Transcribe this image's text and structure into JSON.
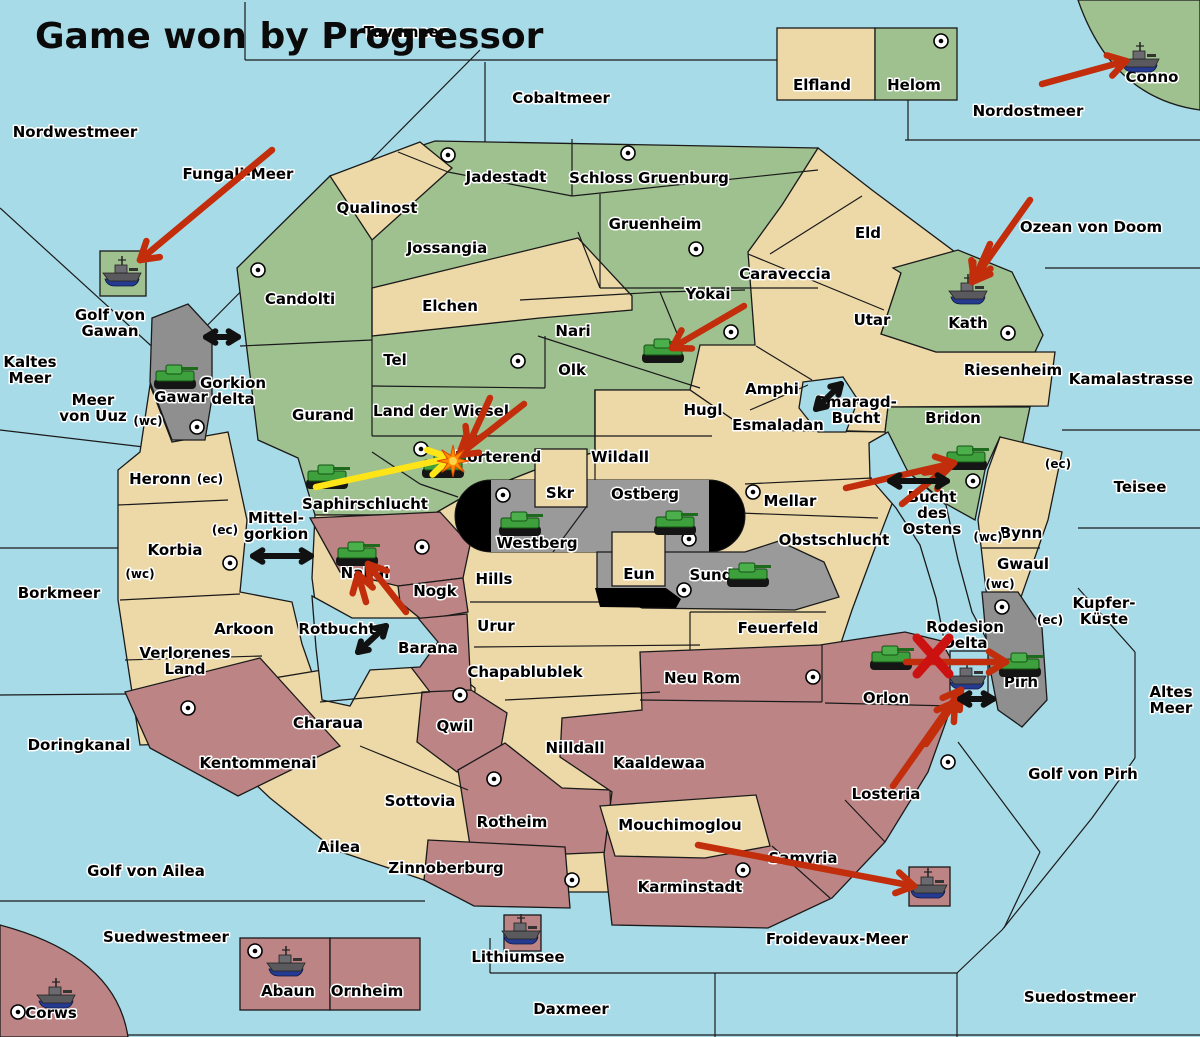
{
  "title": {
    "text": "Game won by Progressor"
  },
  "palette": {
    "sea": "#A8DBE8",
    "green": "#9FC08F",
    "tan": "#EDD9A8",
    "maroon": "#BC8484",
    "gray": "#8F8F8F",
    "stadium_gray": "#9A9A9A",
    "black": "#000000",
    "arrow_red": "#C22D0C",
    "arrow_yellow": "#FFE418",
    "arrow_black": "#111111",
    "x_red": "#CC1111",
    "explosion_orange": "#FF8A00",
    "tank_green": "#3DA03D",
    "ship_hull": "#5A5A5E",
    "ship_keel": "#243B91",
    "border": "#1A1A1A",
    "label_halo": "#FFFFFF"
  },
  "labels": [
    {
      "id": "nordwestmeer",
      "kind": "sea",
      "text": "Nordwestmeer",
      "x": 75,
      "y": 137
    },
    {
      "id": "tuvameer",
      "kind": "sea",
      "text": "Tuvameer",
      "x": 405,
      "y": 37
    },
    {
      "id": "cobaltmeer",
      "kind": "sea",
      "text": "Cobaltmeer",
      "x": 561,
      "y": 103
    },
    {
      "id": "nordostmeer",
      "kind": "sea",
      "text": "Nordostmeer",
      "x": 1028,
      "y": 116
    },
    {
      "id": "fungali-meer",
      "kind": "sea",
      "text": "Fungali-Meer",
      "x": 238,
      "y": 179
    },
    {
      "id": "kaltes-meer",
      "kind": "sea",
      "text": "Kaltes\nMeer",
      "x": 30,
      "y": 375
    },
    {
      "id": "golf-von-gawan",
      "kind": "sea",
      "text": "Golf von\nGawan",
      "x": 110,
      "y": 328
    },
    {
      "id": "meer-von-uuz",
      "kind": "sea",
      "text": "Meer\nvon Uuz",
      "x": 93,
      "y": 413
    },
    {
      "id": "gorkion-delta",
      "kind": "sea",
      "text": "Gorkion\ndelta",
      "x": 233,
      "y": 396
    },
    {
      "id": "borkmeer",
      "kind": "sea",
      "text": "Borkmeer",
      "x": 59,
      "y": 598
    },
    {
      "id": "mittel-gorkion",
      "kind": "sea",
      "text": "Mittel-\ngorkion",
      "x": 276,
      "y": 531
    },
    {
      "id": "rotbucht",
      "kind": "sea",
      "text": "Rotbucht",
      "x": 337,
      "y": 634
    },
    {
      "id": "doringkanal",
      "kind": "sea",
      "text": "Doringkanal",
      "x": 79,
      "y": 750
    },
    {
      "id": "golf-von-ailea",
      "kind": "sea",
      "text": "Golf von Ailea",
      "x": 146,
      "y": 876
    },
    {
      "id": "suedwestmeer",
      "kind": "sea",
      "text": "Suedwestmeer",
      "x": 166,
      "y": 942
    },
    {
      "id": "daxmeer",
      "kind": "sea",
      "text": "Daxmeer",
      "x": 571,
      "y": 1014
    },
    {
      "id": "lithiumsee",
      "kind": "sea",
      "text": "Lithiumsee",
      "x": 518,
      "y": 962
    },
    {
      "id": "froidevaux-meer",
      "kind": "sea",
      "text": "Froidevaux-Meer",
      "x": 837,
      "y": 944
    },
    {
      "id": "suedostmeer",
      "kind": "sea",
      "text": "Suedostmeer",
      "x": 1080,
      "y": 1002
    },
    {
      "id": "golf-von-pirh",
      "kind": "sea",
      "text": "Golf von Pirh",
      "x": 1083,
      "y": 779
    },
    {
      "id": "altes-meer",
      "kind": "sea",
      "text": "Altes\nMeer",
      "x": 1171,
      "y": 705
    },
    {
      "id": "kupfer-kueste",
      "kind": "sea",
      "text": "Kupfer-\nKüste",
      "x": 1104,
      "y": 616
    },
    {
      "id": "teisee",
      "kind": "sea",
      "text": "Teisee",
      "x": 1140,
      "y": 492
    },
    {
      "id": "kamalastrasse",
      "kind": "sea",
      "text": "Kamalastrasse",
      "x": 1131,
      "y": 384
    },
    {
      "id": "ozean-von-doom",
      "kind": "sea",
      "text": "Ozean von Doom",
      "x": 1091,
      "y": 232
    },
    {
      "id": "smaragd-bucht",
      "kind": "sea",
      "text": "Smaragd-\nBucht",
      "x": 856,
      "y": 415
    },
    {
      "id": "bucht-des-ostens",
      "kind": "sea",
      "text": "Bucht\ndes\nOstens",
      "x": 932,
      "y": 518
    },
    {
      "id": "rodesion-delta",
      "kind": "sea",
      "text": "Rodesion\nDelta",
      "x": 965,
      "y": 640
    },
    {
      "id": "elfland",
      "kind": "land",
      "text": "Elfland",
      "x": 822,
      "y": 90
    },
    {
      "id": "helom",
      "kind": "land",
      "text": "Helom",
      "x": 914,
      "y": 90
    },
    {
      "id": "conno",
      "kind": "land",
      "text": "Conno",
      "x": 1152,
      "y": 82
    },
    {
      "id": "jadestadt",
      "kind": "land",
      "text": "Jadestadt",
      "x": 506,
      "y": 182
    },
    {
      "id": "schloss-gruenburg",
      "kind": "land",
      "text": "Schloss Gruenburg",
      "x": 649,
      "y": 183
    },
    {
      "id": "qualinost",
      "kind": "land",
      "text": "Qualinost",
      "x": 377,
      "y": 213
    },
    {
      "id": "jossangia",
      "kind": "land",
      "text": "Jossangia",
      "x": 447,
      "y": 253
    },
    {
      "id": "gruenheim",
      "kind": "land",
      "text": "Gruenheim",
      "x": 655,
      "y": 229
    },
    {
      "id": "eld",
      "kind": "land",
      "text": "Eld",
      "x": 868,
      "y": 238
    },
    {
      "id": "caraveccia",
      "kind": "land",
      "text": "Caraveccia",
      "x": 785,
      "y": 279
    },
    {
      "id": "candolti",
      "kind": "land",
      "text": "Candolti",
      "x": 300,
      "y": 304
    },
    {
      "id": "elchen",
      "kind": "land",
      "text": "Elchen",
      "x": 450,
      "y": 311
    },
    {
      "id": "yokai",
      "kind": "land",
      "text": "Yokai",
      "x": 708,
      "y": 299
    },
    {
      "id": "utar",
      "kind": "land",
      "text": "Utar",
      "x": 872,
      "y": 325
    },
    {
      "id": "kath",
      "kind": "land",
      "text": "Kath",
      "x": 968,
      "y": 328
    },
    {
      "id": "nari",
      "kind": "land",
      "text": "Nari",
      "x": 573,
      "y": 336
    },
    {
      "id": "tel",
      "kind": "land",
      "text": "Tel",
      "x": 395,
      "y": 365
    },
    {
      "id": "olk",
      "kind": "land",
      "text": "Olk",
      "x": 572,
      "y": 375
    },
    {
      "id": "riesenheim",
      "kind": "land",
      "text": "Riesenheim",
      "x": 1013,
      "y": 375
    },
    {
      "id": "gawar",
      "kind": "land",
      "text": "Gawar",
      "x": 181,
      "y": 402
    },
    {
      "id": "amphi",
      "kind": "land",
      "text": "Amphi",
      "x": 772,
      "y": 394
    },
    {
      "id": "hugl",
      "kind": "land",
      "text": "Hugl",
      "x": 703,
      "y": 415
    },
    {
      "id": "land-der-wiesel",
      "kind": "land",
      "text": "Land der Wiesel",
      "x": 441,
      "y": 416
    },
    {
      "id": "esmaladan",
      "kind": "land",
      "text": "Esmaladan",
      "x": 778,
      "y": 430
    },
    {
      "id": "bridon",
      "kind": "land",
      "text": "Bridon",
      "x": 953,
      "y": 423
    },
    {
      "id": "gurand",
      "kind": "land",
      "text": "Gurand",
      "x": 323,
      "y": 420
    },
    {
      "id": "norterend",
      "kind": "land",
      "text": "Norterend",
      "x": 498,
      "y": 462
    },
    {
      "id": "wildall",
      "kind": "land",
      "text": "Wildall",
      "x": 620,
      "y": 462
    },
    {
      "id": "heronn",
      "kind": "land",
      "text": "Heronn",
      "x": 160,
      "y": 484
    },
    {
      "id": "skr",
      "kind": "land",
      "text": "Skr",
      "x": 560,
      "y": 498
    },
    {
      "id": "ostberg",
      "kind": "land",
      "text": "Ostberg",
      "x": 645,
      "y": 499
    },
    {
      "id": "mellar",
      "kind": "land",
      "text": "Mellar",
      "x": 790,
      "y": 506
    },
    {
      "id": "saphirschlucht",
      "kind": "land",
      "text": "Saphirschlucht",
      "x": 365,
      "y": 509
    },
    {
      "id": "westberg",
      "kind": "land",
      "text": "Westberg",
      "x": 537,
      "y": 548
    },
    {
      "id": "korbia",
      "kind": "land",
      "text": "Korbia",
      "x": 175,
      "y": 555
    },
    {
      "id": "obstschlucht",
      "kind": "land",
      "text": "Obstschlucht",
      "x": 834,
      "y": 545
    },
    {
      "id": "bynn",
      "kind": "land",
      "text": "Bynn",
      "x": 1021,
      "y": 538
    },
    {
      "id": "gwaul",
      "kind": "land",
      "text": "Gwaul",
      "x": 1023,
      "y": 569
    },
    {
      "id": "nabai",
      "kind": "land",
      "text": "Nabai",
      "x": 365,
      "y": 578
    },
    {
      "id": "nogk",
      "kind": "land",
      "text": "Nogk",
      "x": 435,
      "y": 596
    },
    {
      "id": "hills",
      "kind": "land",
      "text": "Hills",
      "x": 494,
      "y": 584
    },
    {
      "id": "eun",
      "kind": "land",
      "text": "Eun",
      "x": 639,
      "y": 579
    },
    {
      "id": "sund",
      "kind": "land",
      "text": "Sund",
      "x": 711,
      "y": 580
    },
    {
      "id": "arkoon",
      "kind": "land",
      "text": "Arkoon",
      "x": 244,
      "y": 634
    },
    {
      "id": "barana",
      "kind": "land",
      "text": "Barana",
      "x": 428,
      "y": 653
    },
    {
      "id": "urur",
      "kind": "land",
      "text": "Urur",
      "x": 496,
      "y": 631
    },
    {
      "id": "feuerfeld",
      "kind": "land",
      "text": "Feuerfeld",
      "x": 778,
      "y": 633
    },
    {
      "id": "verlorenes-land",
      "kind": "land",
      "text": "Verlorenes\nLand",
      "x": 185,
      "y": 666
    },
    {
      "id": "chapablublek",
      "kind": "land",
      "text": "Chapablublek",
      "x": 525,
      "y": 677
    },
    {
      "id": "neu-rom",
      "kind": "land",
      "text": "Neu Rom",
      "x": 702,
      "y": 683
    },
    {
      "id": "pirh",
      "kind": "land",
      "text": "Pirh",
      "x": 1021,
      "y": 687
    },
    {
      "id": "orlon",
      "kind": "land",
      "text": "Orlon",
      "x": 886,
      "y": 703
    },
    {
      "id": "qwil",
      "kind": "land",
      "text": "Qwil",
      "x": 455,
      "y": 731
    },
    {
      "id": "charaua",
      "kind": "land",
      "text": "Charaua",
      "x": 328,
      "y": 728
    },
    {
      "id": "nilldall",
      "kind": "land",
      "text": "Nilldall",
      "x": 575,
      "y": 753
    },
    {
      "id": "kentommenai",
      "kind": "land",
      "text": "Kentommenai",
      "x": 258,
      "y": 768
    },
    {
      "id": "kaaldewaa",
      "kind": "land",
      "text": "Kaaldewaa",
      "x": 659,
      "y": 768
    },
    {
      "id": "losteria",
      "kind": "land",
      "text": "Losteria",
      "x": 886,
      "y": 799
    },
    {
      "id": "sottovia",
      "kind": "land",
      "text": "Sottovia",
      "x": 420,
      "y": 806
    },
    {
      "id": "rotheim",
      "kind": "land",
      "text": "Rotheim",
      "x": 512,
      "y": 827
    },
    {
      "id": "mouchimoglou",
      "kind": "land",
      "text": "Mouchimoglou",
      "x": 680,
      "y": 830
    },
    {
      "id": "ailea",
      "kind": "land",
      "text": "Ailea",
      "x": 339,
      "y": 852
    },
    {
      "id": "samyria",
      "kind": "land",
      "text": "Samyria",
      "x": 803,
      "y": 863
    },
    {
      "id": "zinnoberburg",
      "kind": "land",
      "text": "Zinnoberburg",
      "x": 446,
      "y": 873
    },
    {
      "id": "karminstadt",
      "kind": "land",
      "text": "Karminstadt",
      "x": 690,
      "y": 892
    },
    {
      "id": "abaun",
      "kind": "land",
      "text": "Abaun",
      "x": 288,
      "y": 996
    },
    {
      "id": "ornheim",
      "kind": "land",
      "text": "Ornheim",
      "x": 367,
      "y": 996
    },
    {
      "id": "corws",
      "kind": "land",
      "text": "Corws",
      "x": 51,
      "y": 1018
    },
    {
      "id": "ec-heronn",
      "kind": "small",
      "text": "(ec)",
      "x": 210,
      "y": 483
    },
    {
      "id": "ec-korbia",
      "kind": "small",
      "text": "(ec)",
      "x": 225,
      "y": 534
    },
    {
      "id": "wc-korbia",
      "kind": "small",
      "text": "(wc)",
      "x": 140,
      "y": 578
    },
    {
      "id": "wc-meer-von-uuz",
      "kind": "small",
      "text": "(wc)",
      "x": 148,
      "y": 425
    },
    {
      "id": "ec-teisee-side",
      "kind": "small",
      "text": "(ec)",
      "x": 1058,
      "y": 468
    },
    {
      "id": "wc-bynn",
      "kind": "small",
      "text": "(wc)",
      "x": 988,
      "y": 541
    },
    {
      "id": "wc-gwaul",
      "kind": "small",
      "text": "(wc)",
      "x": 1000,
      "y": 588
    },
    {
      "id": "ec-kupfer",
      "kind": "small",
      "text": "(ec)",
      "x": 1050,
      "y": 624
    }
  ],
  "supply_centers": [
    {
      "region": "Helom",
      "x": 941,
      "y": 41
    },
    {
      "region": "Jadestadt",
      "x": 448,
      "y": 155
    },
    {
      "region": "Schloss Gruenburg",
      "x": 628,
      "y": 153
    },
    {
      "region": "Gruenheim",
      "x": 696,
      "y": 249
    },
    {
      "region": "Candolti",
      "x": 258,
      "y": 270
    },
    {
      "region": "Yokai",
      "x": 731,
      "y": 332
    },
    {
      "region": "Kath",
      "x": 1008,
      "y": 333
    },
    {
      "region": "Tel",
      "x": 518,
      "y": 361
    },
    {
      "region": "Gawar",
      "x": 197,
      "y": 427
    },
    {
      "region": "Norterend",
      "x": 421,
      "y": 449
    },
    {
      "region": "Bridon coast",
      "x": 973,
      "y": 481
    },
    {
      "region": "Mellar",
      "x": 753,
      "y": 492
    },
    {
      "region": "Westberg",
      "x": 503,
      "y": 495
    },
    {
      "region": "Ostberg",
      "x": 689,
      "y": 539
    },
    {
      "region": "Nabai",
      "x": 422,
      "y": 547
    },
    {
      "region": "Korbia",
      "x": 230,
      "y": 563
    },
    {
      "region": "Sund",
      "x": 684,
      "y": 590
    },
    {
      "region": "Rodesion Delta",
      "x": 1002,
      "y": 607
    },
    {
      "region": "Neu Rom",
      "x": 813,
      "y": 677
    },
    {
      "region": "Qwil",
      "x": 460,
      "y": 695
    },
    {
      "region": "Kentommenai",
      "x": 188,
      "y": 708
    },
    {
      "region": "Losteria",
      "x": 948,
      "y": 762
    },
    {
      "region": "Rotheim",
      "x": 494,
      "y": 779
    },
    {
      "region": "Zinnoberburg",
      "x": 572,
      "y": 880
    },
    {
      "region": "Karminstadt",
      "x": 743,
      "y": 870
    },
    {
      "region": "Abaun",
      "x": 255,
      "y": 951
    },
    {
      "region": "Corws",
      "x": 18,
      "y": 1012
    }
  ],
  "units": [
    {
      "type": "tank",
      "region": "Gawar",
      "x": 175,
      "y": 378
    },
    {
      "type": "tank",
      "region": "Olk",
      "x": 663,
      "y": 352
    },
    {
      "type": "tank",
      "region": "Saphirschlucht",
      "x": 327,
      "y": 478
    },
    {
      "type": "tank",
      "region": "Norterend",
      "x": 443,
      "y": 467,
      "exploded": true
    },
    {
      "type": "tank",
      "region": "Westberg",
      "x": 520,
      "y": 525
    },
    {
      "type": "tank",
      "region": "Ostberg",
      "x": 675,
      "y": 524
    },
    {
      "type": "tank",
      "region": "Sund",
      "x": 748,
      "y": 576
    },
    {
      "type": "tank",
      "region": "Nabai",
      "x": 357,
      "y": 555
    },
    {
      "type": "tank",
      "region": "Bridon coast",
      "x": 966,
      "y": 459
    },
    {
      "type": "tank",
      "region": "Orlon",
      "x": 891,
      "y": 659
    },
    {
      "type": "tank",
      "region": "Pirh",
      "x": 1020,
      "y": 666
    },
    {
      "type": "ship",
      "region": "Golf von Gawan",
      "x": 122,
      "y": 274
    },
    {
      "type": "ship",
      "region": "Conno",
      "x": 1140,
      "y": 60
    },
    {
      "type": "ship",
      "region": "Kath",
      "x": 968,
      "y": 292
    },
    {
      "type": "ship",
      "region": "Rodesion Delta",
      "x": 967,
      "y": 677
    },
    {
      "type": "ship",
      "region": "Froidevaux-Meer",
      "x": 928,
      "y": 886
    },
    {
      "type": "ship",
      "region": "Lithiumsee",
      "x": 521,
      "y": 932
    },
    {
      "type": "ship",
      "region": "Abaun",
      "x": 286,
      "y": 964
    },
    {
      "type": "ship",
      "region": "Corws",
      "x": 56,
      "y": 996
    }
  ],
  "arrows": [
    {
      "id": "fungali-to-gawan",
      "color": "red",
      "x1": 272,
      "y1": 150,
      "x2": 140,
      "y2": 260
    },
    {
      "id": "to-conno",
      "color": "red",
      "x1": 1042,
      "y1": 84,
      "x2": 1126,
      "y2": 61
    },
    {
      "id": "to-kath",
      "color": "red",
      "x1": 1030,
      "y1": 200,
      "x2": 972,
      "y2": 282
    },
    {
      "id": "to-kath-prong",
      "color": "red",
      "x1": 990,
      "y1": 244,
      "x2": 974,
      "y2": 280
    },
    {
      "id": "yokai-to-olk",
      "color": "red",
      "x1": 744,
      "y1": 306,
      "x2": 672,
      "y2": 348
    },
    {
      "id": "to-norterend-1",
      "color": "red",
      "x1": 524,
      "y1": 404,
      "x2": 459,
      "y2": 455
    },
    {
      "id": "to-norterend-2",
      "color": "red",
      "x1": 490,
      "y1": 398,
      "x2": 468,
      "y2": 446
    },
    {
      "id": "saphir-to-norterend",
      "color": "yellow",
      "x1": 316,
      "y1": 487,
      "x2": 450,
      "y2": 458
    },
    {
      "id": "to-nabai",
      "color": "red",
      "x1": 406,
      "y1": 612,
      "x2": 368,
      "y2": 564
    },
    {
      "id": "to-nabai-prong",
      "color": "red",
      "x1": 366,
      "y1": 602,
      "x2": 358,
      "y2": 574
    },
    {
      "id": "to-bridon-coast",
      "color": "red",
      "x1": 846,
      "y1": 488,
      "x2": 954,
      "y2": 463
    },
    {
      "id": "to-bridon-coast-prong",
      "color": "red",
      "x1": 902,
      "y1": 504,
      "x2": 944,
      "y2": 470
    },
    {
      "id": "orlon-to-pirh",
      "color": "red",
      "x1": 906,
      "y1": 662,
      "x2": 1006,
      "y2": 662
    },
    {
      "id": "losteria-to-delta",
      "color": "red",
      "x1": 893,
      "y1": 786,
      "x2": 961,
      "y2": 690
    },
    {
      "id": "losteria-to-delta-prong",
      "color": "red",
      "x1": 926,
      "y1": 744,
      "x2": 955,
      "y2": 702
    },
    {
      "id": "karminstadt-to-froidevaux",
      "color": "red",
      "x1": 698,
      "y1": 845,
      "x2": 914,
      "y2": 886
    }
  ],
  "double_arrows": [
    {
      "id": "gawar-candolti",
      "x1": 206,
      "y1": 337,
      "x2": 238,
      "y2": 337
    },
    {
      "id": "mittelgorkion",
      "x1": 253,
      "y1": 556,
      "x2": 311,
      "y2": 556
    },
    {
      "id": "rotbucht",
      "x1": 358,
      "y1": 652,
      "x2": 386,
      "y2": 626
    },
    {
      "id": "smaragd-bucht",
      "x1": 816,
      "y1": 409,
      "x2": 841,
      "y2": 384
    },
    {
      "id": "bucht-des-ostens",
      "x1": 890,
      "y1": 481,
      "x2": 947,
      "y2": 481
    },
    {
      "id": "pirh-delta",
      "x1": 960,
      "y1": 699,
      "x2": 993,
      "y2": 699
    }
  ],
  "marks": [
    {
      "type": "x",
      "id": "blocked-move-x",
      "x": 933,
      "y": 656
    },
    {
      "type": "explosion",
      "id": "norterend-explosion",
      "x": 453,
      "y": 461
    }
  ]
}
